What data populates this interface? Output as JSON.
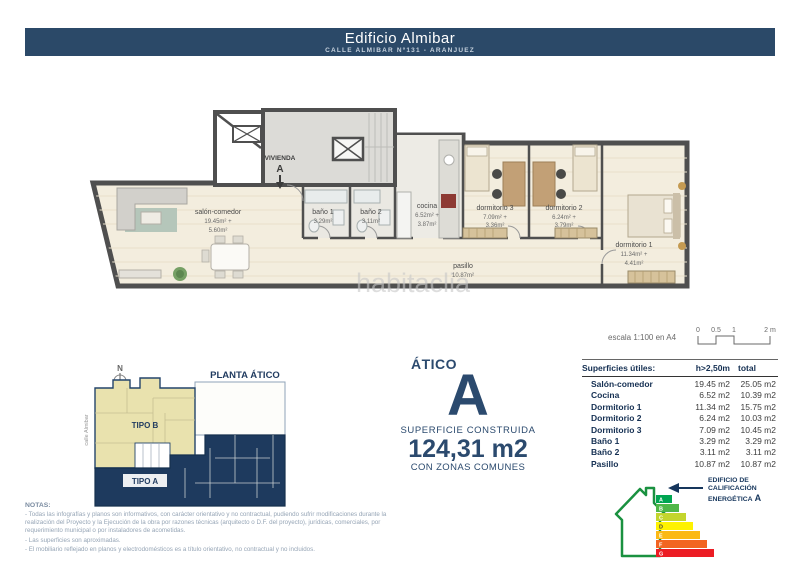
{
  "header": {
    "title": "Edificio Almibar",
    "subtitle": "CALLE ALMIBAR Nº131 - ARANJUEZ"
  },
  "floorplan": {
    "unit": {
      "label": "VIVIENDA",
      "letter": "A"
    },
    "rooms": {
      "salon": {
        "name": "salón-comedor",
        "a1": "19.45m² +",
        "a2": "5.60m²"
      },
      "banio1": {
        "name": "baño 1",
        "a1": "3.29m²"
      },
      "banio2": {
        "name": "baño 2",
        "a1": "3.11m²"
      },
      "cocina": {
        "name": "cocina",
        "a1": "6.52m² +",
        "a2": "3.87m²"
      },
      "dorm3": {
        "name": "dormitorio 3",
        "a1": "7.09m² +",
        "a2": "3.36m²"
      },
      "dorm2": {
        "name": "dormitorio 2",
        "a1": "6.24m² +",
        "a2": "3.79m²"
      },
      "dorm1": {
        "name": "dormitorio 1",
        "a1": "11.34m² +",
        "a2": "4.41m²"
      },
      "pasillo": {
        "name": "pasillo",
        "a1": "10.87m²"
      }
    },
    "watermark": "habitaclia"
  },
  "scale": {
    "label": "escala 1:100 en A4",
    "ticks": [
      "0",
      "0.5",
      "1",
      "2 m"
    ]
  },
  "siteplan": {
    "title": "PLANTA ÁTICO",
    "north": "N",
    "street": "calle Almibar",
    "tipo_b": "TIPO B",
    "tipo_a": "TIPO A"
  },
  "summary": {
    "type_label": "ÁTICO",
    "letter": "A",
    "line1": "SUPERFICIE CONSTRUIDA",
    "area": "124,31 m2",
    "line2": "CON ZONAS COMUNES"
  },
  "table": {
    "col1": "Superficies útiles:",
    "col2": "h>2,50m",
    "col3": "total",
    "rows": [
      {
        "name": "Salón-comedor",
        "h": "19.45 m2",
        "t": "25.05 m2"
      },
      {
        "name": "Cocina",
        "h": "6.52 m2",
        "t": "10.39 m2"
      },
      {
        "name": "Dormitorio 1",
        "h": "11.34 m2",
        "t": "15.75 m2"
      },
      {
        "name": "Dormitorio 2",
        "h": "6.24 m2",
        "t": "10.03 m2"
      },
      {
        "name": "Dormitorio 3",
        "h": "7.09 m2",
        "t": "10.45 m2"
      },
      {
        "name": "Baño 1",
        "h": "3.29 m2",
        "t": "3.29 m2"
      },
      {
        "name": "Baño 2",
        "h": "3.11 m2",
        "t": "3.11 m2"
      },
      {
        "name": "Pasillo",
        "h": "10.87 m2",
        "t": "10.87 m2"
      }
    ]
  },
  "energy": {
    "label_line1": "EDIFICIO DE",
    "label_line2": "CALIFICACIÓN",
    "label_line3": "ENERGÉTICA",
    "letter": "A",
    "ratings": [
      "A",
      "B",
      "C",
      "D",
      "E",
      "F",
      "G"
    ],
    "colors": [
      "#00a551",
      "#4fb748",
      "#c3d52d",
      "#fef200",
      "#fbb914",
      "#f26522",
      "#ec1c24"
    ]
  },
  "notes": {
    "title": "NOTAS:",
    "items": [
      "- Todas las infografías y planos son informativos, con carácter orientativo y no contractual, pudiendo sufrir modificaciones durante la realización del Proyecto y la Ejecución de la obra por razones técnicas (arquitecto o D.F. del proyecto), jurídicas, comerciales, por requerimiento municipal o por instaladores de acometidas.",
      "- Las superficies son aproximadas.",
      "- El mobiliario reflejado en planos y electrodomésticos es a título orientativo, no contractual y no incluidos."
    ]
  },
  "colors": {
    "navy": "#2b4968",
    "site_beige": "#e9e2ae",
    "site_navy": "#1e3a5e",
    "wall_gray": "#4f4f4f",
    "floor": "#f3edde"
  }
}
